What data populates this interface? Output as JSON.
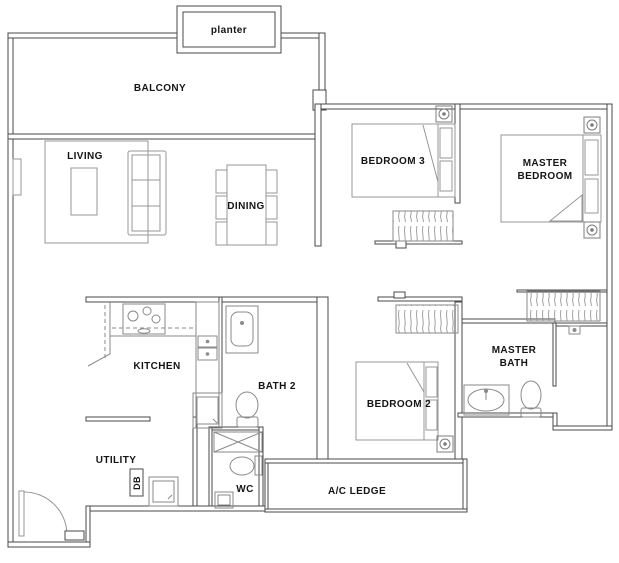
{
  "plan": {
    "colors": {
      "background": "#ffffff",
      "wall": "#4a4a4a",
      "furniture": "#979797",
      "fixture": "#8a8a8a",
      "label": "#151515"
    },
    "rooms": {
      "planter": "planter",
      "balcony": "BALCONY",
      "living": "LIVING",
      "dining": "DINING",
      "bedroom3": "BEDROOM 3",
      "master_bedroom": {
        "line1": "MASTER",
        "line2": "BEDROOM"
      },
      "kitchen": "KITCHEN",
      "bath2": "BATH 2",
      "bedroom2": "BEDROOM 2",
      "master_bath": {
        "line1": "MASTER",
        "line2": "BATH"
      },
      "utility": "UTILITY",
      "db": "DB",
      "wc": "WC",
      "ac_ledge": "A/C LEDGE"
    }
  }
}
